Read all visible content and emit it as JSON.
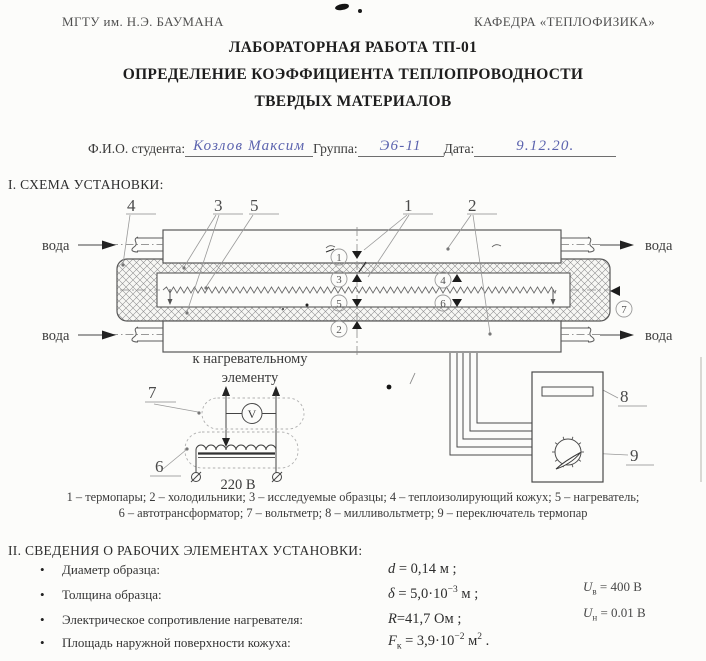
{
  "header": {
    "org_left": "МГТУ им. Н.Э. БАУМАНА",
    "org_right": "КАФЕДРА «ТЕПЛОФИЗИКА»",
    "title_line1": "ЛАБОРАТОРНАЯ РАБОТА ТП-01",
    "title_line2": "ОПРЕДЕЛЕНИЕ КОЭФФИЦИЕНТА ТЕПЛОПРОВОДНОСТИ",
    "title_line3": "ТВЕРДЫХ МАТЕРИАЛОВ"
  },
  "student": {
    "fio_label": "Ф.И.О. студента:",
    "fio_value": "Козлов Максим",
    "group_label": "Группа:",
    "group_value": "Э6-11",
    "date_label": "Дата:",
    "date_value": "9.12.20."
  },
  "scheme": {
    "heading": "I. СХЕМА УСТАНОВКИ:",
    "water": "вода",
    "to_heater_line1": "к нагревательному",
    "to_heater_line2": "элементу",
    "mains_voltage": "220 В",
    "voltmeter_glyph": "V",
    "callout_1": "1",
    "callout_2": "2",
    "callout_3": "3",
    "callout_4": "4",
    "callout_5": "5",
    "callout_6": "6",
    "callout_7": "7",
    "callout_8": "8",
    "callout_9": "9",
    "tp_1": "1",
    "tp_2": "2",
    "tp_3": "3",
    "tp_4": "4",
    "tp_5": "5",
    "tp_6": "6",
    "tp_7": "7",
    "legend_line1": "1 – термопары; 2 – холодильники; 3 – исследуемые образцы; 4 – теплоизолирующий кожух; 5 – нагреватель;",
    "legend_line2": "6 – автотрансформатор; 7 – вольтметр; 8 – милливольтметр; 9 – переключатель термопар"
  },
  "elements": {
    "heading": "II. СВЕДЕНИЯ О РАБОЧИХ ЭЛЕМЕНТАХ УСТАНОВКИ:",
    "items": [
      {
        "label": "Диаметр образца:",
        "v": "d",
        "sub": "",
        "eq": " = 0,14",
        "sup": "",
        "unit": " м",
        "usup": "",
        "end": " ;"
      },
      {
        "label": "Толщина образца:",
        "v": "δ",
        "sub": "",
        "eq": " = 5,0·10",
        "sup": "−3",
        "unit": " м",
        "usup": "",
        "end": " ;"
      },
      {
        "label": "Электрическое сопротивление нагревателя:",
        "v": "R",
        "sub": "",
        "eq": "=41,7",
        "sup": "",
        "unit": " Ом",
        "usup": "",
        "end": " ;"
      },
      {
        "label": "Площадь наружной поверхности кожуха:",
        "v": "F",
        "sub": "к",
        "eq": " = 3,9·10",
        "sup": "−2",
        "unit": " м",
        "usup": "2",
        "end": " ."
      }
    ],
    "side_note_1": {
      "v": "U",
      "sub": "в",
      "eq": " = 400 В"
    },
    "side_note_2": {
      "v": "U",
      "sub": "н",
      "eq": " = 0.01 В"
    }
  },
  "colors": {
    "ink": "#2f2f2f",
    "diagram_line": "#5f5f5f",
    "light_line": "#9a9a9a",
    "handwriting_blue": "#5b63ae"
  }
}
